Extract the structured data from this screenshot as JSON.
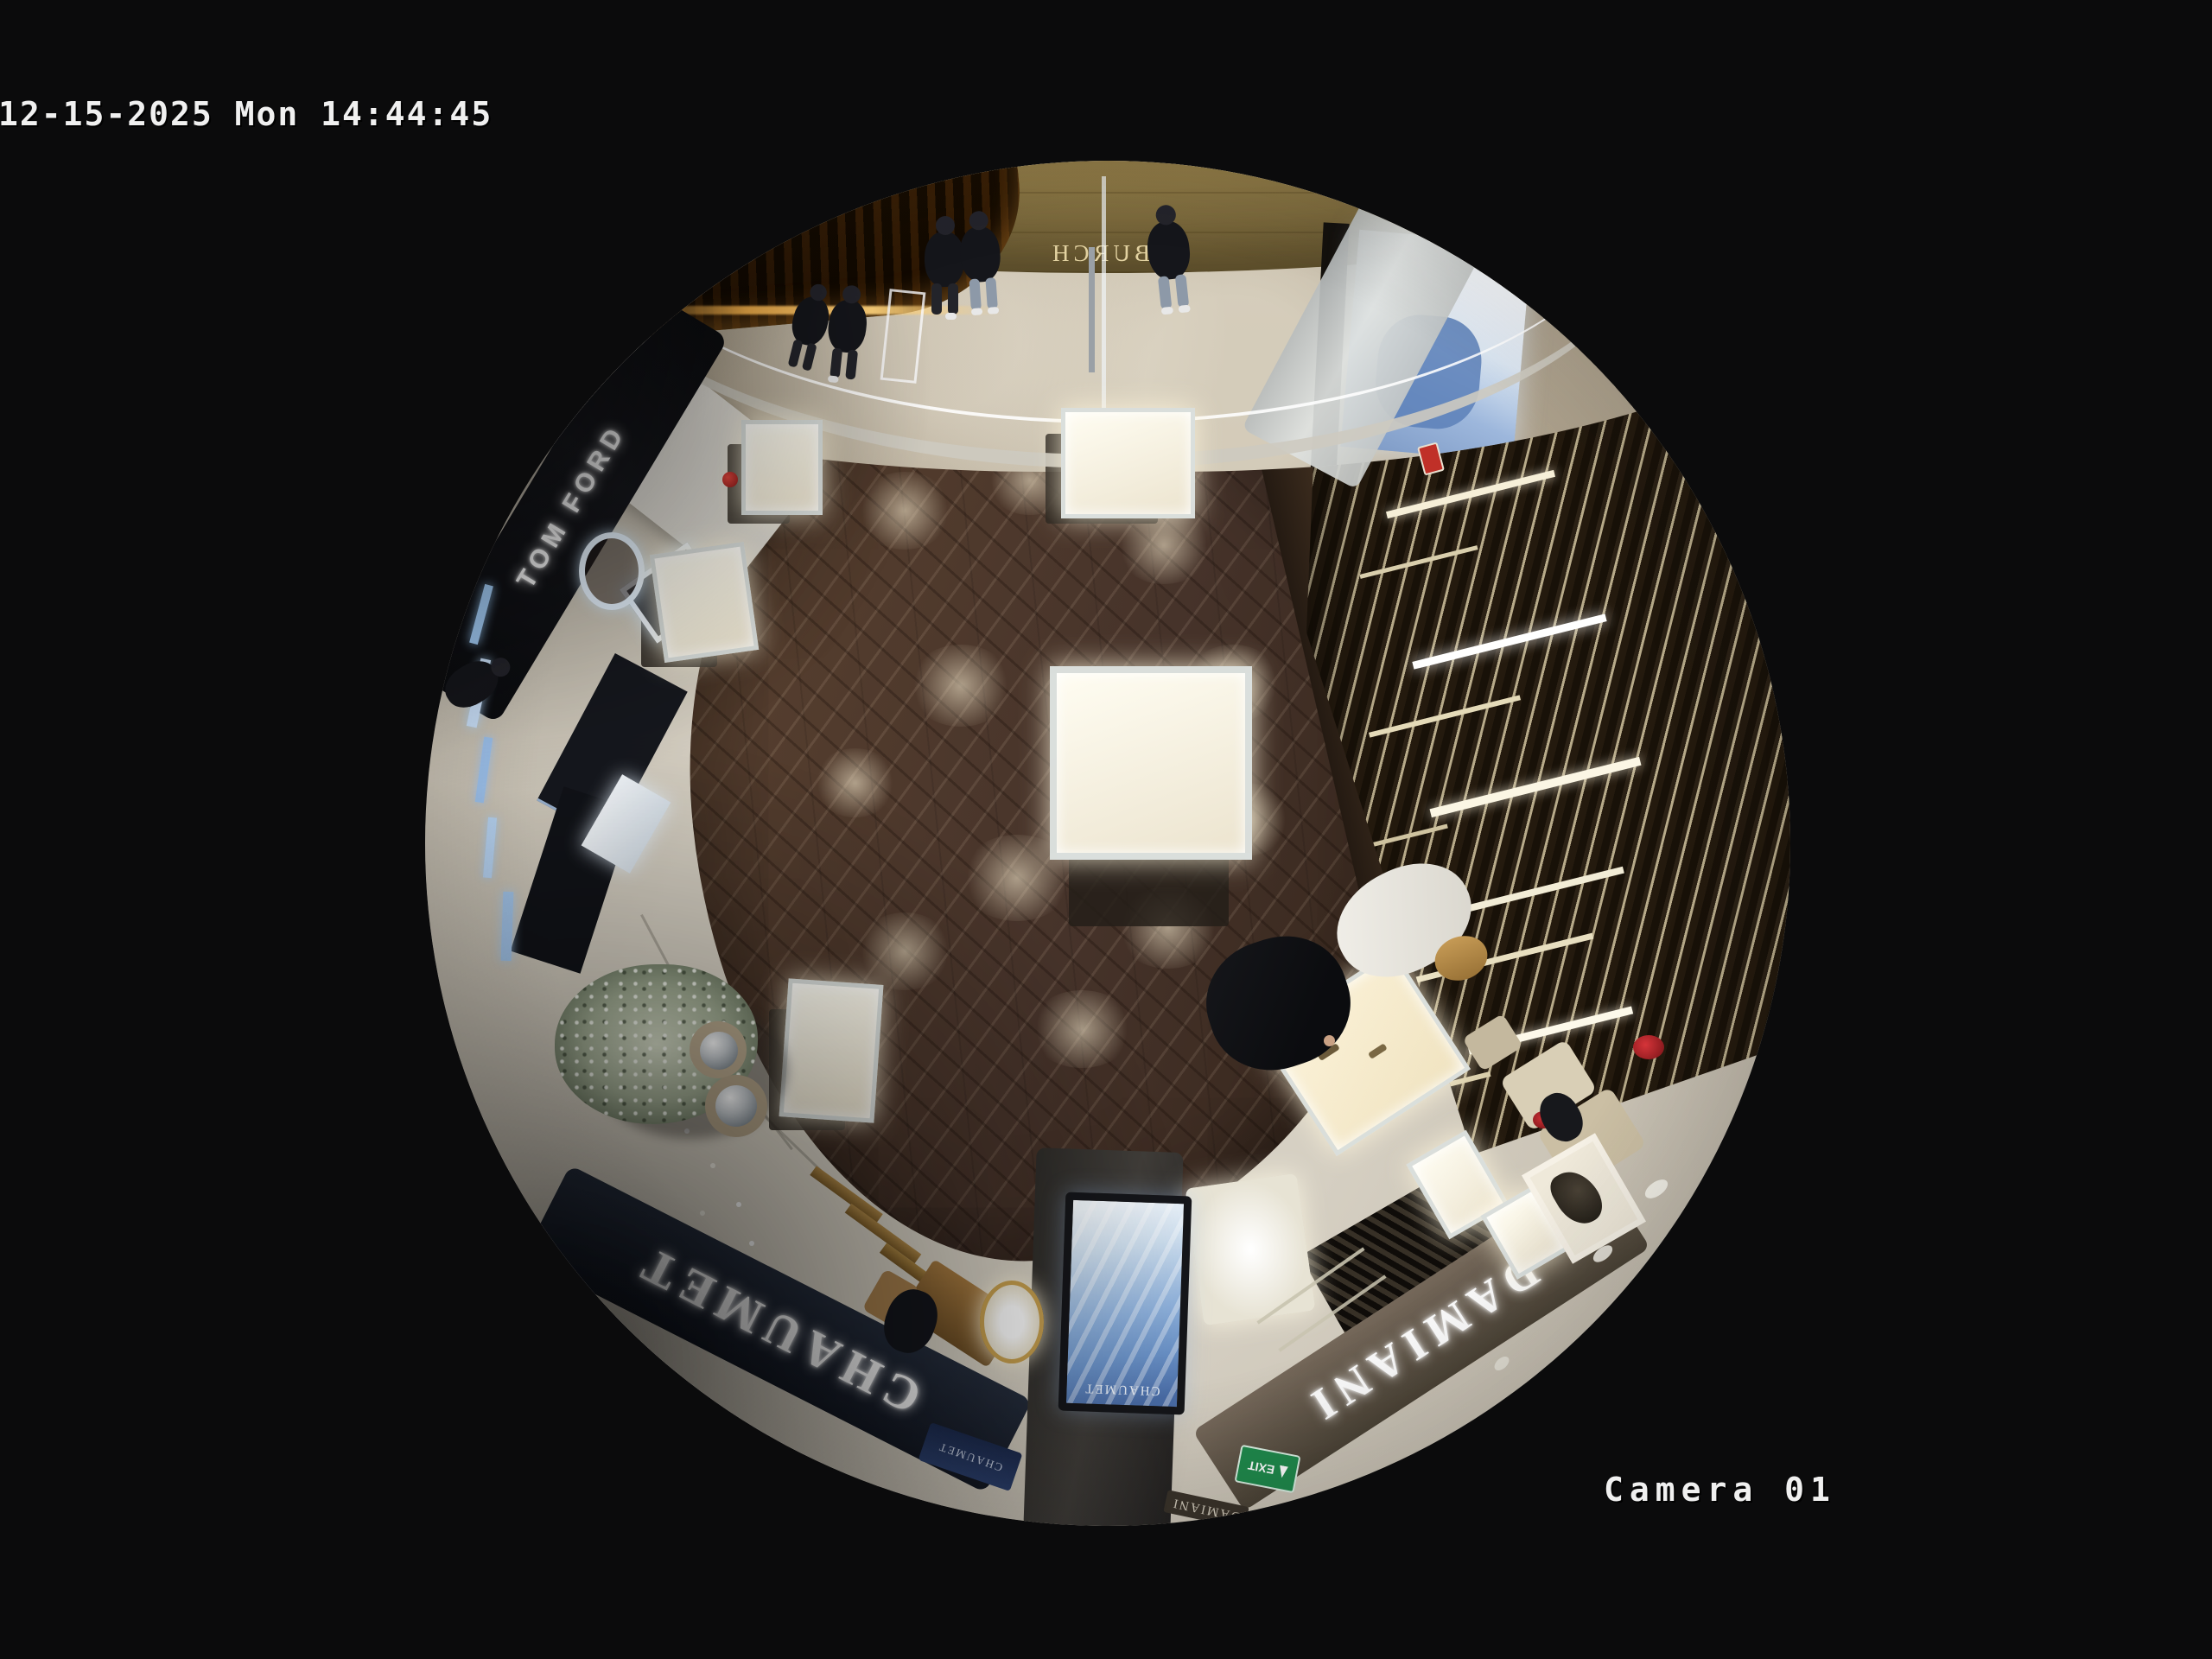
{
  "osd": {
    "timestamp": "12-15-2025 Mon 14:44:45",
    "camera_label": "Camera 01"
  },
  "signs": {
    "chaumet_fascia": "CHAUMET",
    "chaumet_screen": "CHAUMET",
    "chaumet_banner": "CHAUMET",
    "damiani_fascia": "DAMIANI",
    "damiani_secondary": "DAMIANI",
    "tom_ford": "TOM FORD",
    "tf_monogram": "TF",
    "burch": "BURCH",
    "exit": "EXIT"
  },
  "colors": {
    "frame_background": "#0b0b0c",
    "osd_text": "#f0f0f0",
    "wood_floor": "#4a3528",
    "store_tile": "#cfc8ba",
    "corridor_marble": "#b2a794",
    "corridor_gold_wall": "#9a8450",
    "chaumet_fascia_bg": "#1c2330",
    "damiani_fascia_bg": "#5f5546",
    "tomford_fascia_bg": "#0d0e12",
    "screen_blue": "#8fb2dd",
    "exit_green": "#1f8a4c",
    "display_case_glow": "#fff6dc",
    "christmas_tree": "#a3ae95"
  }
}
